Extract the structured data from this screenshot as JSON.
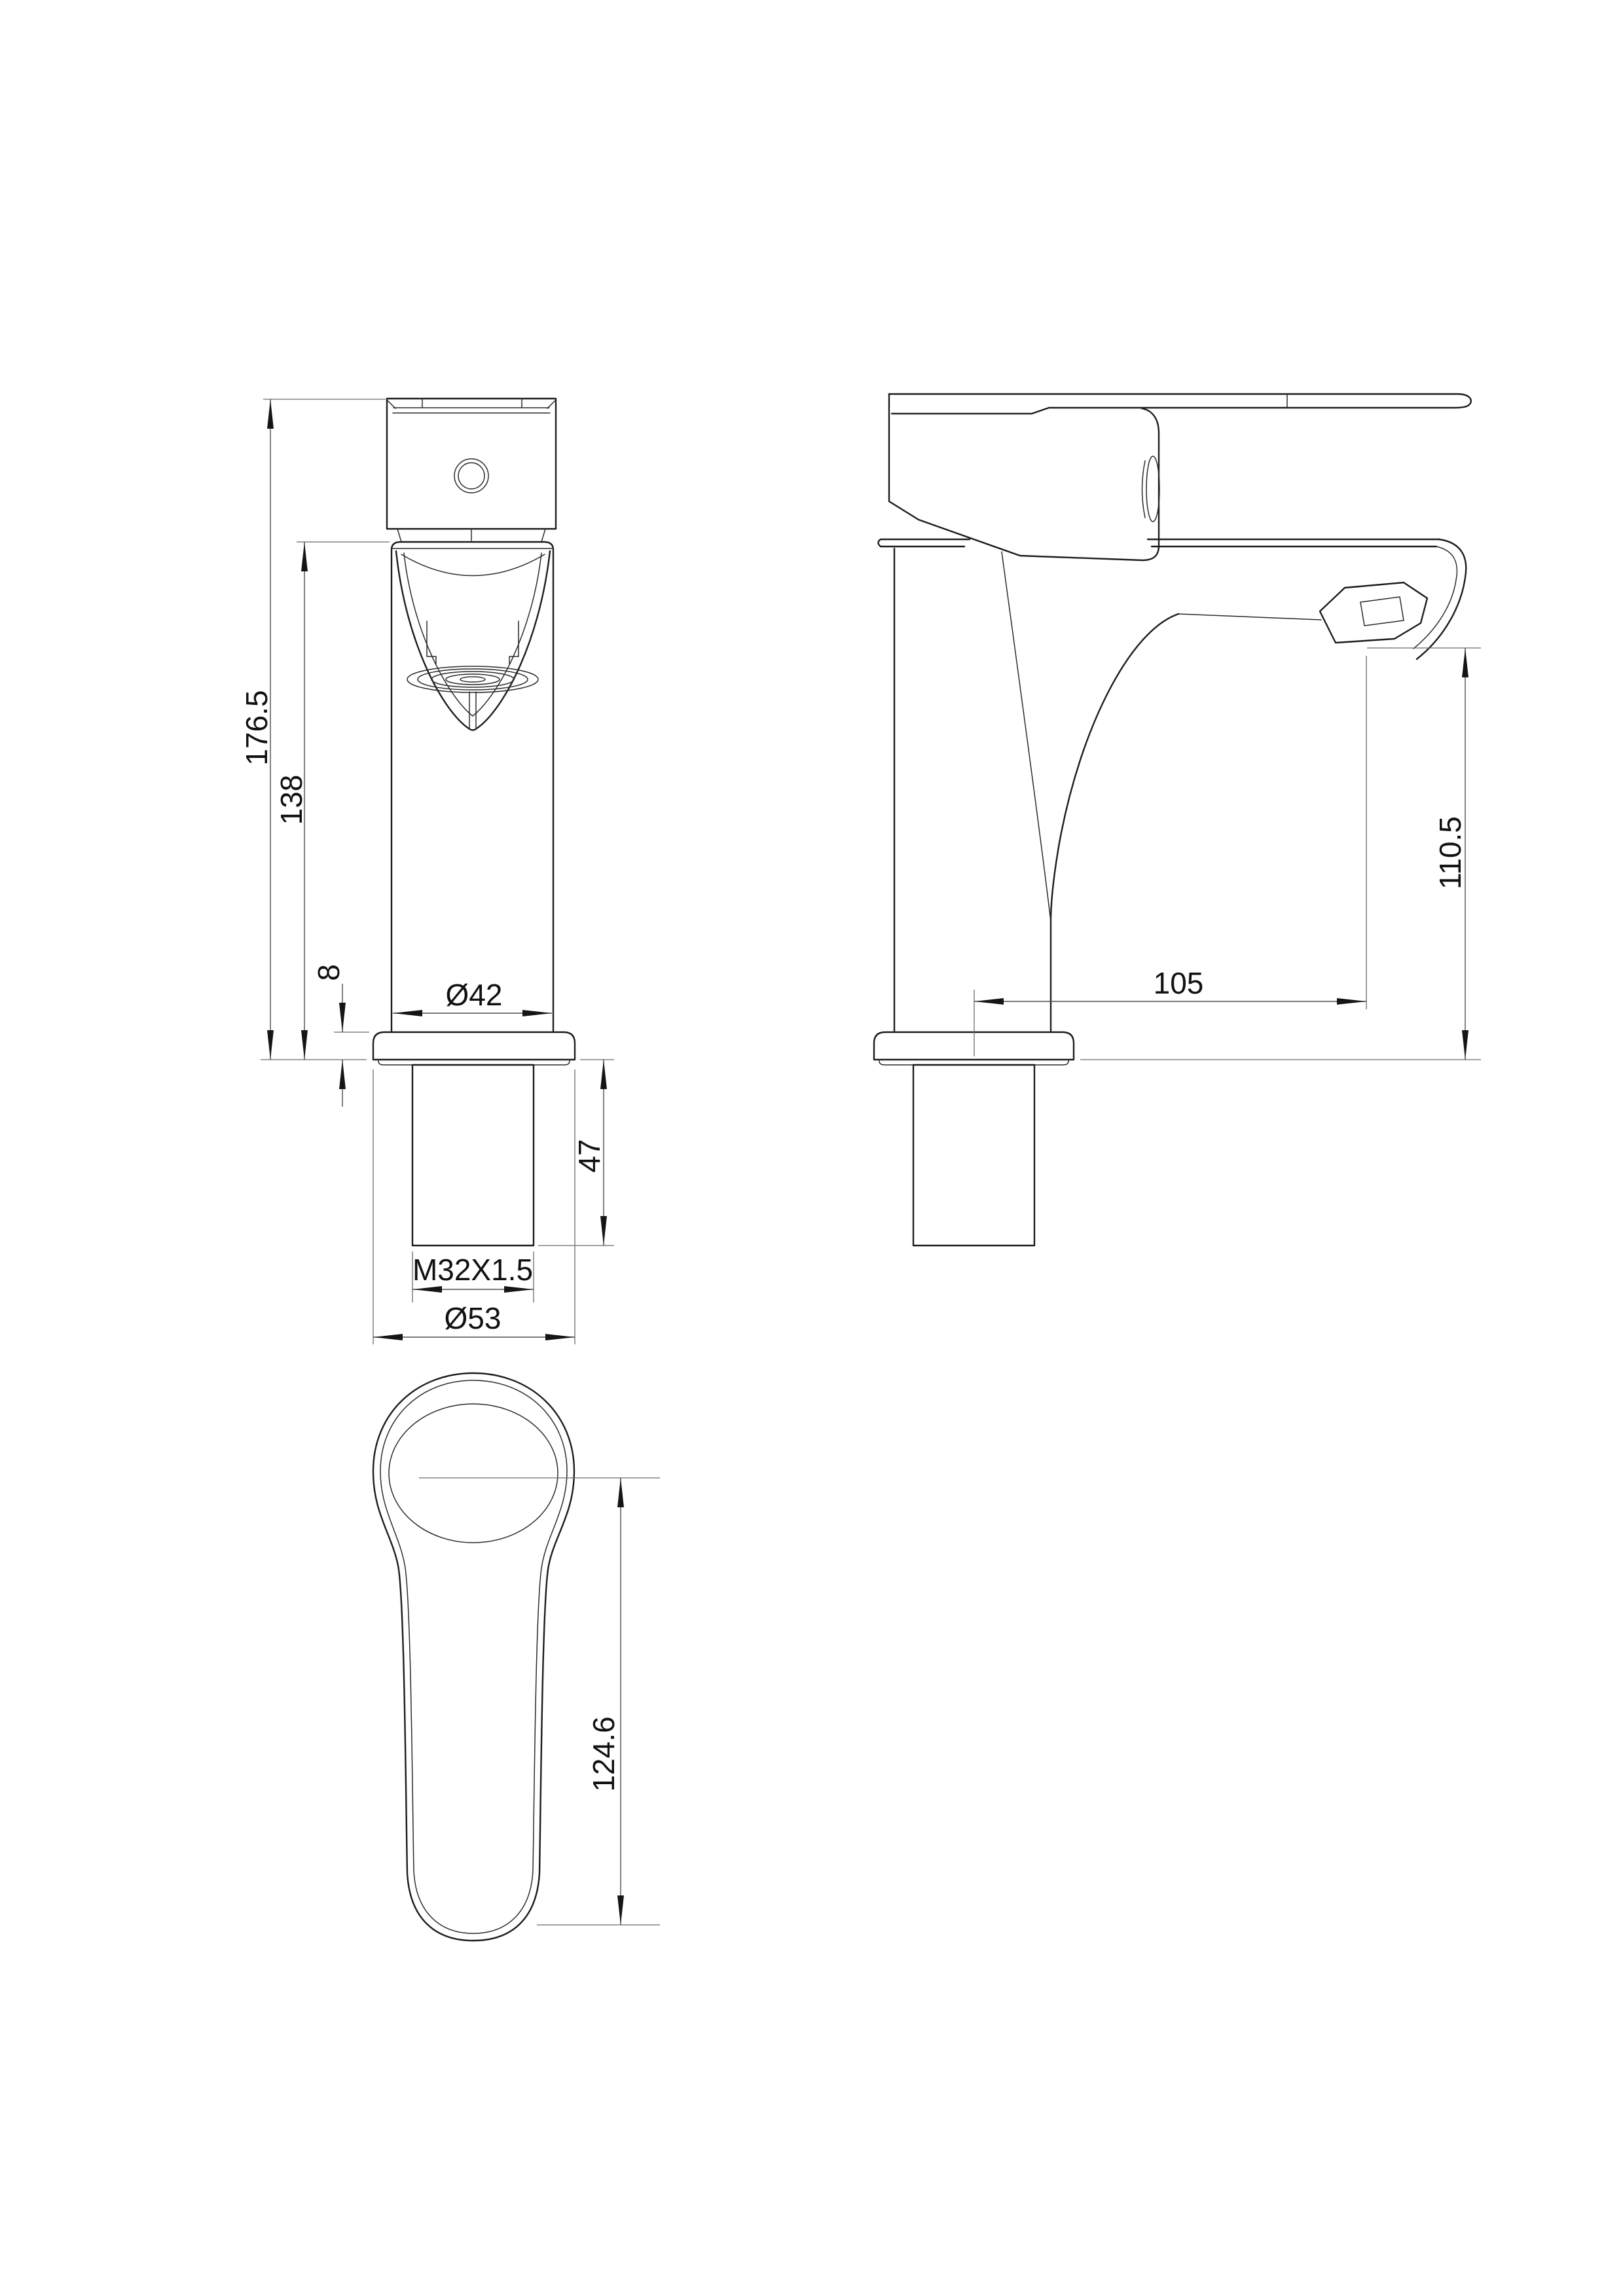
{
  "page": {
    "background": "#ffffff",
    "object_line_color": "#1c1c1c",
    "dimension_line_color": "#4d4d4d",
    "text_color": "#111111"
  },
  "drawing": {
    "dims": {
      "overall_height": "176.5",
      "body_height": "138",
      "flange_thickness": "8",
      "body_diameter": "Ø42",
      "shank_length": "47",
      "thread_spec": "M32X1.5",
      "flange_diameter": "Ø53",
      "spout_reach": "105",
      "outlet_height": "110.5",
      "handle_length": "124.6"
    }
  }
}
